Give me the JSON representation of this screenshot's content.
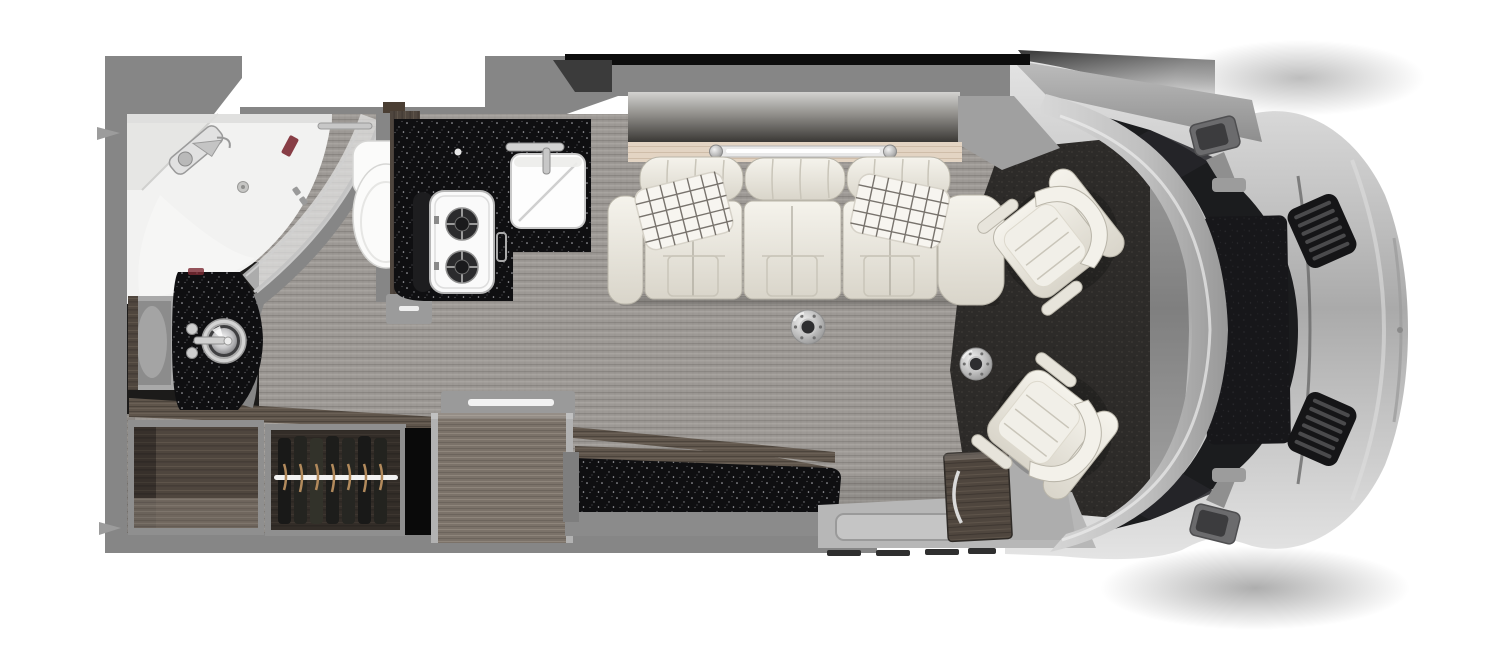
{
  "meta": {
    "title": "Class B motorhome floor plan - top-down interior rendering",
    "width": 1500,
    "height": 667
  },
  "palette": {
    "bg": "#ffffff",
    "wall": "#868686",
    "wall_dark": "#707070",
    "floor_base": "#9d9995",
    "floor_stripe": "#8a8682",
    "floor_stripe_light": "#b4b0aa",
    "cab_carpet": "#2d2b29",
    "cab_carpet_dot": "#413e3a",
    "counter_black": "#0f0f11",
    "speckle": "#d2d2d8",
    "wood_dark": "#4f463e",
    "wood_dark_line": "#60564c",
    "wood_mid": "#7b7269",
    "wood_mid_line": "#8e857b",
    "wood_light": "#e3d4c3",
    "wood_light_line": "#cbb8a3",
    "wood_floor": "#5f554b",
    "cream": "#edeae2",
    "cream_hi": "#f5f3ec",
    "cream_shade": "#d9d5ca",
    "cream_line": "#b9b5a9",
    "chrome": "#cccccc",
    "chrome_dark": "#8e8e8e",
    "white_fixture": "#f4f4f3",
    "glass": "#e4e4e4",
    "silver_light": "#e2e2e2",
    "silver": "#bfbfbf",
    "silver_dark": "#a0a0a0",
    "windshield": "#1b1c1e",
    "black": "#0d0d0d",
    "accent_red": "#7c2a33",
    "step_gray": "#b7b7b7",
    "pillow_grid": "#57534c",
    "led_white": "#ffffff"
  },
  "areas": [
    {
      "name": "wet-bath",
      "items": [
        "corner-shower",
        "shower-glass-door",
        "shower-head",
        "drain",
        "toilet",
        "grab-bar"
      ]
    },
    {
      "name": "vanity",
      "items": [
        "vessel-sink",
        "faucet",
        "mirror-cabinet-door",
        "black-countertop"
      ]
    },
    {
      "name": "galley",
      "items": [
        "two-burner-cooktop",
        "square-sink",
        "faucet",
        "l-shaped-countertop",
        "wood-cabinet-face"
      ]
    },
    {
      "name": "lounge",
      "items": [
        "three-seat-sofa",
        "plaid-pillow-left",
        "plaid-pillow-right",
        "wood-shelf",
        "led-strip-light",
        "window-band",
        "table-mount-front",
        "table-mount-rear"
      ]
    },
    {
      "name": "storage",
      "items": [
        "open-cabinet",
        "wardrobe-with-hangers",
        "tall-cabinet-refrigerator",
        "upholstered-bench",
        "nightstand-cabinet",
        "wood-floor-strip"
      ]
    },
    {
      "name": "entry",
      "items": [
        "step-well",
        "door-sill-vents"
      ]
    },
    {
      "name": "cab",
      "items": [
        "passenger-swivel-seat",
        "driver-swivel-seat",
        "cab-carpet",
        "windshield",
        "windshield-frame"
      ]
    },
    {
      "name": "exterior",
      "items": [
        "awning-rail",
        "awning-bracket-front",
        "awning-bracket-rear",
        "side-mirror-upper",
        "side-mirror-lower",
        "hood-vent-upper",
        "hood-vent-lower",
        "front-bumper",
        "engine-cover"
      ]
    }
  ]
}
